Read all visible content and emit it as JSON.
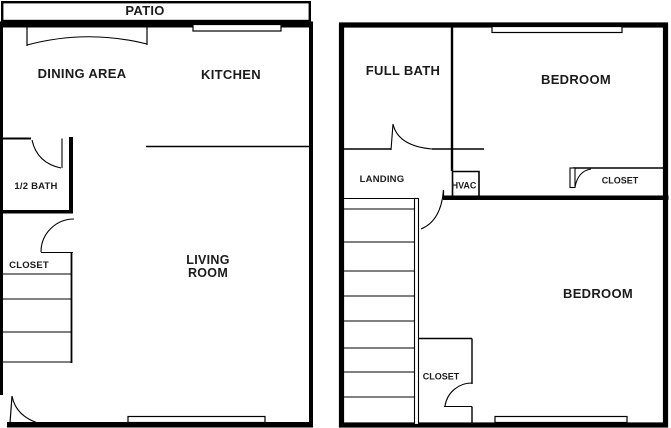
{
  "document_type": "floor-plan",
  "colors": {
    "background": "#ffffff",
    "line": "#000000",
    "text": "#1b1b1b"
  },
  "floor1": {
    "patio": "PATIO",
    "dining_area": "DINING AREA",
    "kitchen": "KITCHEN",
    "half_bath": "1/2 BATH",
    "closet": "CLOSET",
    "living_room": "LIVING ROOM"
  },
  "floor2": {
    "full_bath": "FULL BATH",
    "bedroom_upper": "BEDROOM",
    "landing": "LANDING",
    "hvac": "HVAC",
    "closet_upper": "CLOSET",
    "bedroom_lower": "BEDROOM",
    "closet_lower": "CLOSET"
  }
}
